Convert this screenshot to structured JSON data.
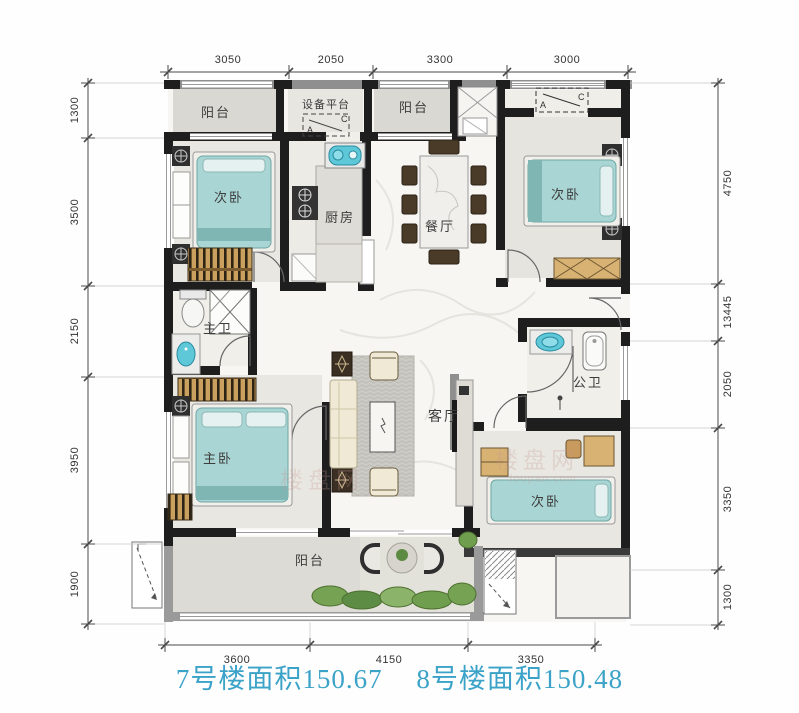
{
  "title": {
    "building7": "7号楼面积150.67",
    "building8": "8号楼面积150.48",
    "color": "#3ba2c8"
  },
  "rooms": {
    "balcony_top_left": "阳台",
    "equipment_platform": "设备平台",
    "balcony_top_right": "阳台",
    "bedroom_top_left": "次卧",
    "kitchen": "厨房",
    "dining_room": "餐厅",
    "bedroom_top_right": "次卧",
    "master_bathroom": "主卫",
    "public_bathroom": "公卫",
    "living_room": "客厅",
    "master_bedroom": "主卧",
    "bedroom_bottom_right": "次卧",
    "balcony_bottom": "阳台"
  },
  "ac_unit": {
    "left_letter": "A",
    "right_letter": "C"
  },
  "dimensions": {
    "top": [
      "3050",
      "2050",
      "3300",
      "3000"
    ],
    "left": [
      "1300",
      "3500",
      "2150",
      "3950",
      "1900"
    ],
    "right": [
      "4750",
      "13445",
      "2050",
      "3350",
      "1300"
    ],
    "bottom": [
      "3600",
      "4150",
      "3350"
    ]
  },
  "watermark": {
    "cn": "楼盘网",
    "en": "loupan.com"
  },
  "colors": {
    "bed": "#a9d6d4",
    "sink": "#5ec7d8",
    "wall": "#1e1e1e",
    "plant": "#76a254",
    "wood": "#caa05f",
    "title_blue": "#3ba2c8"
  }
}
